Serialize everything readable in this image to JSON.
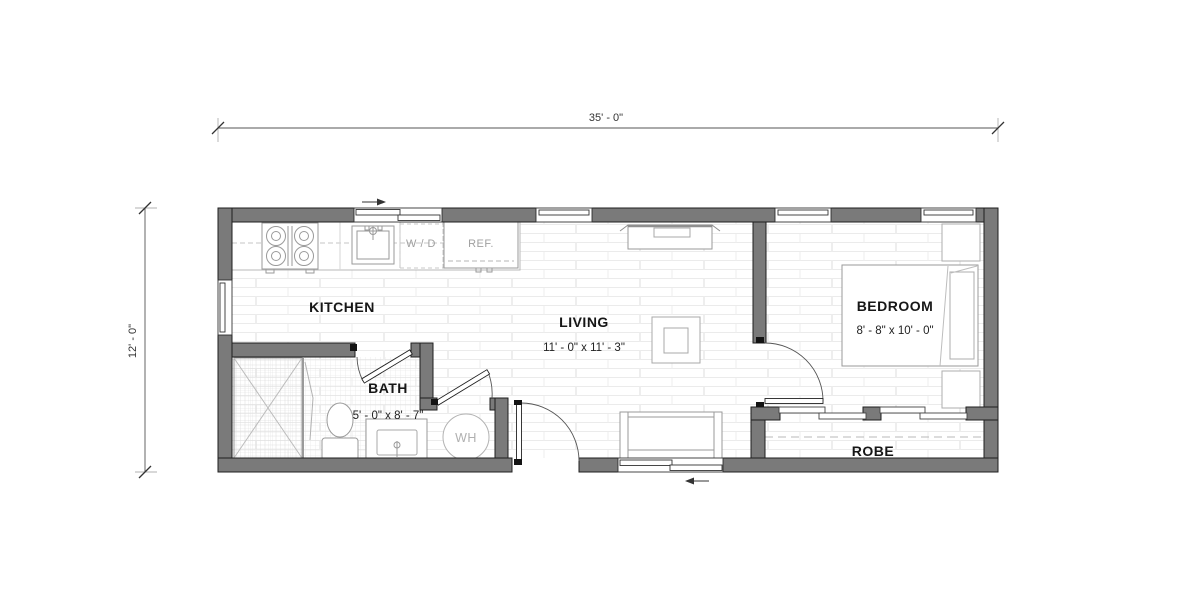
{
  "plan": {
    "dimensions": {
      "overall_width": "35' - 0\"",
      "overall_height": "12' - 0\""
    },
    "rooms": {
      "kitchen": {
        "label": "KITCHEN"
      },
      "living": {
        "label": "LIVING",
        "size": "11' - 0\" x 11' - 3\""
      },
      "bath": {
        "label": "BATH",
        "size": "5' - 0\" x 8' - 7\""
      },
      "bedroom": {
        "label": "BEDROOM",
        "size": "8' - 8\" x 10' - 0\""
      },
      "robe": {
        "label": "ROBE"
      }
    },
    "fixtures": {
      "washer_dryer": "W / D",
      "refrigerator": "REF.",
      "water_heater": "WH"
    },
    "colors": {
      "wall_fill": "#7a7a7a",
      "wall_outline": "#1f1f1f",
      "fixture_line": "#9a9a9a",
      "floor_line": "#ebebeb",
      "label_text": "#161616",
      "muted_text": "#a0a0a0"
    }
  }
}
